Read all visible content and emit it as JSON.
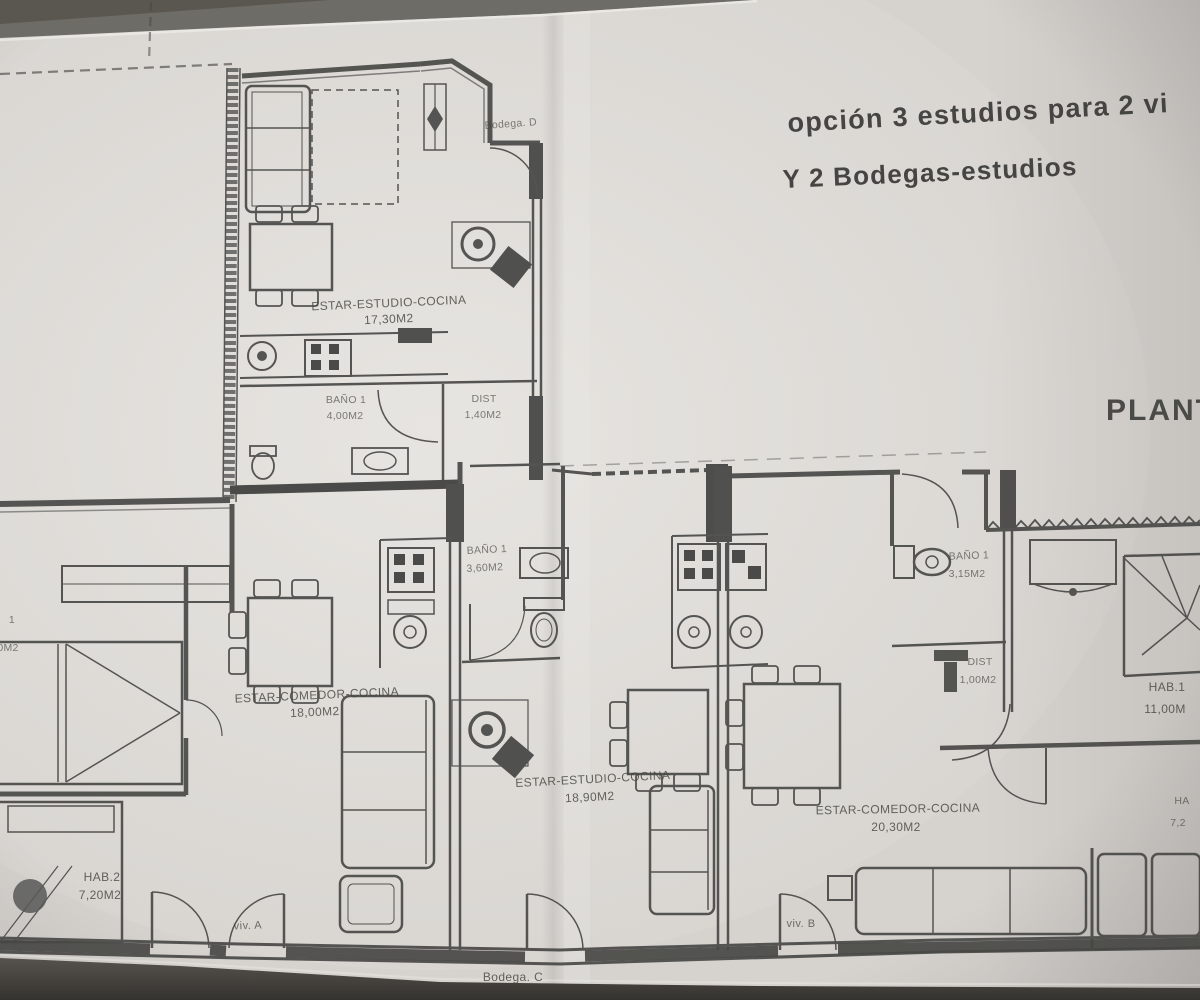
{
  "document": {
    "type": "architectural floor plan photograph",
    "title_line1": "opción 3 estudios para 2 vi",
    "title_line2": "Y 2 Bodegas-estudios",
    "plan_title": "PLANT"
  },
  "units": {
    "bodega_d": "Bodega. D",
    "bodega_c": "Bodega. C",
    "viv_a": "viv. A",
    "viv_b": "viv. B"
  },
  "labels": {
    "estudio_d_name": "ESTAR-ESTUDIO-COCINA",
    "estudio_d_area": "17,30M2",
    "bano_d_name": "BAÑO 1",
    "bano_d_area": "4,00M2",
    "dist_d_name": "DIST",
    "dist_d_area": "1,40M2",
    "bano_c_name": "BAÑO 1",
    "bano_c_area": "3,60M2",
    "estar_a_name": "ESTAR-COMEDOR-COCINA",
    "estar_a_area": "18,00M2",
    "hab1_a_partial": "1",
    "hab1_a_area_partial": "0M2",
    "hab2_a_name": "HAB.2",
    "hab2_a_area": "7,20M2",
    "estudio_c_name": "ESTAR-ESTUDIO-COCINA",
    "estudio_c_area": "18,90M2",
    "estar_b_name": "ESTAR-COMEDOR-COCINA",
    "estar_b_area": "20,30M2",
    "bano_b_name": "BAÑO 1",
    "bano_b_area": "3,15M2",
    "dist_b_name": "DIST",
    "dist_b_area": "1,00M2",
    "hab1_b_name": "HAB.1",
    "hab1_b_area": "11,00M",
    "hab2_b_name_partial": "HA",
    "hab2_b_area_partial": "7,2"
  },
  "palette": {
    "paper": "#d8d5d1",
    "ink": "#4a4a48",
    "dark_wall": "#3d3d3b",
    "shadow": "#55534f"
  }
}
